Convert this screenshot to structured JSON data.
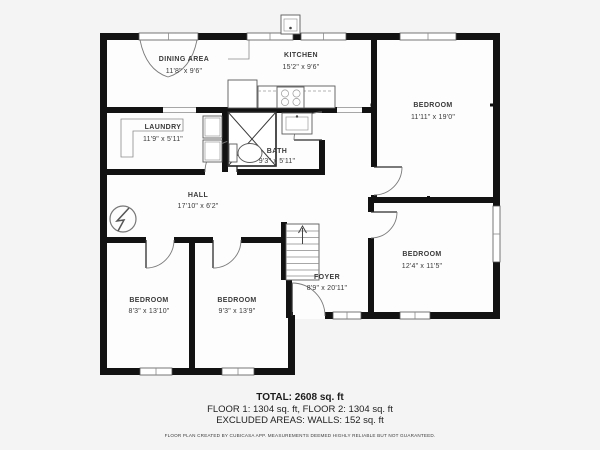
{
  "plan": {
    "rooms": [
      {
        "name": "DINING AREA",
        "dims": "11'8\" x 9'6\""
      },
      {
        "name": "KITCHEN",
        "dims": "15'2\" x 9'6\""
      },
      {
        "name": "BEDROOM",
        "dims": "11'11\" x 19'0\""
      },
      {
        "name": "LAUNDRY",
        "dims": "11'9\" x 5'11\""
      },
      {
        "name": "BATH",
        "dims": "9'3\" x 5'11\""
      },
      {
        "name": "HALL",
        "dims": "17'10\" x 6'2\""
      },
      {
        "name": "FOYER",
        "dims": "8'9\" x 20'11\""
      },
      {
        "name": "BEDROOM",
        "dims": "12'4\" x 11'5\""
      },
      {
        "name": "BEDROOM",
        "dims": "8'3\" x 13'10\""
      },
      {
        "name": "BEDROOM",
        "dims": "9'3\" x 13'9\""
      }
    ],
    "fixtures": [
      "refrigerator",
      "stove",
      "kitchen-sink",
      "washer",
      "dryer",
      "laundry-counter",
      "shower",
      "bathroom-sink",
      "toilet",
      "staircase",
      "electrical-panel"
    ],
    "colors": {
      "wall": "#121212",
      "background": "#f4f4f5",
      "floor": "#fdfdfe",
      "label": "#3a3a3a"
    }
  },
  "footer": {
    "total": "TOTAL: 2608 sq. ft",
    "floors": "FLOOR 1: 1304 sq. ft, FLOOR 2: 1304 sq. ft",
    "excluded": "EXCLUDED AREAS: WALLS: 152 sq. ft",
    "disclaimer": "FLOOR PLAN CREATED BY CUBICASA APP. MEASUREMENTS DEEMED HIGHLY RELIABLE BUT NOT GUARANTEED."
  }
}
